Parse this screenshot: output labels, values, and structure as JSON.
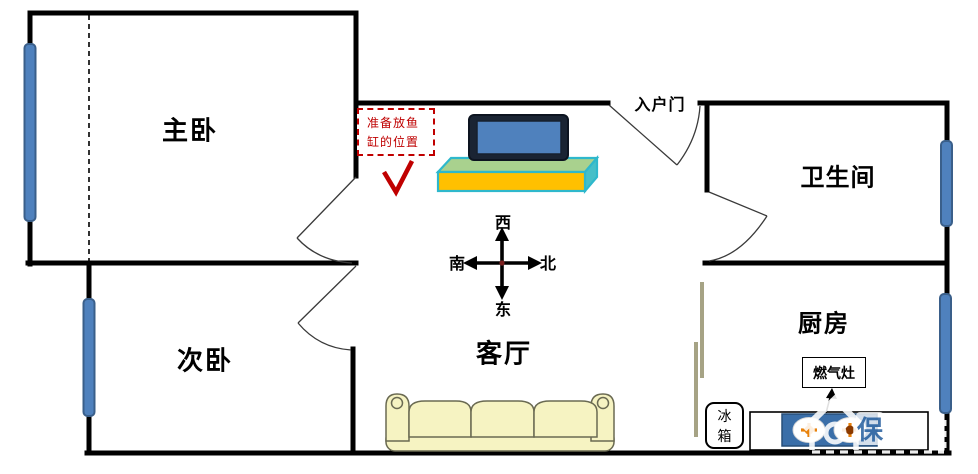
{
  "rooms": {
    "master": "主卧",
    "second": "次卧",
    "living": "客厅",
    "bathroom": "卫生间",
    "kitchen": "厨房"
  },
  "entrance": {
    "label": "入户门"
  },
  "fish_tank_note": {
    "line1": "准备放鱼",
    "line2": "缸的位置",
    "full_text": "准备放鱼缸的位置"
  },
  "compass": {
    "west": "西",
    "east": "东",
    "south": "南",
    "north": "北"
  },
  "kitchen_items": {
    "stove": "燃气灶",
    "fridge": "冰箱"
  },
  "watermark": {
    "badge": "保"
  },
  "colors": {
    "wall": "#000000",
    "window": "#4F81BD",
    "note_red": "#C00000",
    "stand_front": "#FFC000",
    "stand_top": "#A9D18E",
    "stand_border": "#2EB8CC",
    "tv_screen": "#4F81BD",
    "sofa": "#F6F3C2",
    "stove_blue": "#3A6EA8",
    "slider_olive": "#A6A385"
  }
}
